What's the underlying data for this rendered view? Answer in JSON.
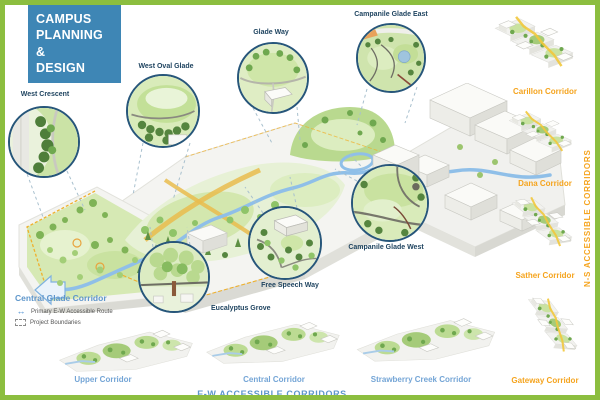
{
  "page": {
    "title": "CAMPUS PLANNING & DESIGN",
    "title_lines": {
      "l1": "CAMPUS",
      "l2": "PLANNING &",
      "l3": "DESIGN"
    }
  },
  "colors": {
    "frame_green": "#8CBE3F",
    "header_blue": "#3E86B5",
    "callout_navy": "#1F4460",
    "corridor_orange": "#F5A41E",
    "corridor_blue": "#74A5D6",
    "section_blue": "#5E96CB",
    "creek_blue": "#8FBFE8",
    "boundary_orange": "#EFB02C"
  },
  "callouts": [
    {
      "label": "West Crescent"
    },
    {
      "label": "West Oval Glade"
    },
    {
      "label": "Glade Way"
    },
    {
      "label": "Campanile Glade East"
    },
    {
      "label": "Campanile Glade West"
    },
    {
      "label": "Free Speech Way"
    },
    {
      "label": "Eucalyptus Grove"
    }
  ],
  "ns": {
    "heading": "N-S ACCESSIBLE CORRIDORS",
    "items": [
      {
        "label": "Carillon Corridor"
      },
      {
        "label": "Dana Corridor"
      },
      {
        "label": "Sather Corridor"
      },
      {
        "label": "Gateway Corridor"
      }
    ]
  },
  "ew": {
    "heading": "E-W ACCESSIBLE CORRIDORS",
    "items": [
      {
        "label": "Upper Corridor"
      },
      {
        "label": "Central Corridor"
      },
      {
        "label": "Strawberry Creek Corridor"
      }
    ]
  },
  "legend": {
    "heading": "Central Glade Corridor",
    "items": [
      {
        "icon": "double-arrow-icon",
        "label": "Primary E-W Accessible Route"
      },
      {
        "icon": "dashed-boundary-icon",
        "label": "Project Boundaries"
      }
    ]
  }
}
